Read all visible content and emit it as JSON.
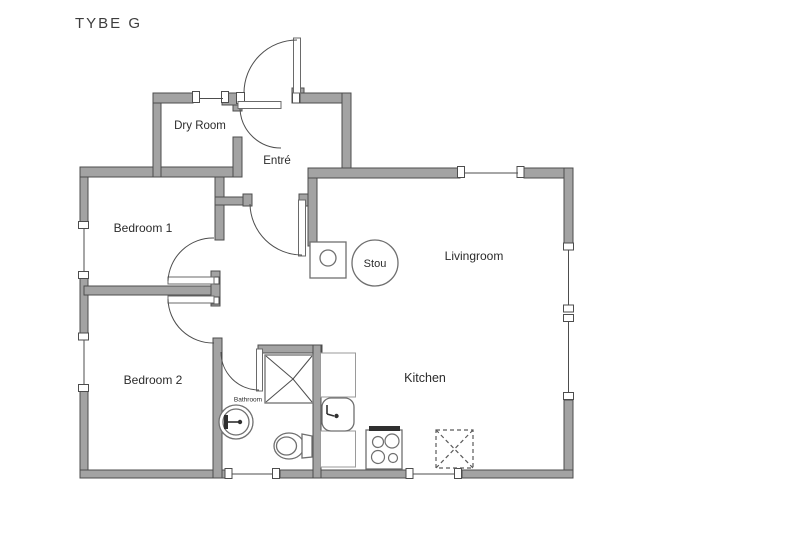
{
  "title": "TYBE G",
  "plan": {
    "rooms": {
      "dry_room": {
        "label": "Dry Room"
      },
      "entre": {
        "label": "Entré"
      },
      "bedroom_1": {
        "label": "Bedroom 1"
      },
      "bedroom_2": {
        "label": "Bedroom 2"
      },
      "livingroom": {
        "label": "Livingroom"
      },
      "kitchen": {
        "label": "Kitchen"
      },
      "bathroom": {
        "label": "Bathroom"
      },
      "stou": {
        "label": "Stou"
      }
    },
    "fixtures": [
      "entrance-door",
      "dry-room-door",
      "hall-door",
      "bedroom-1-door",
      "bedroom-2-door",
      "bathroom-door",
      "shower",
      "washbasin",
      "toilet",
      "kitchen-counter",
      "kitchen-sink",
      "cooker",
      "appliance-space-dashed",
      "wood-stove-plate",
      "stou-stove-circle"
    ],
    "windows_count": 8
  },
  "colors": {
    "background": "#ffffff",
    "wall_fill": "#a3a3a3",
    "wall_stroke": "#4d4d4d",
    "line": "#6f6f6f",
    "text": "#2b2b2b",
    "title_text": "#3d3d3d"
  }
}
